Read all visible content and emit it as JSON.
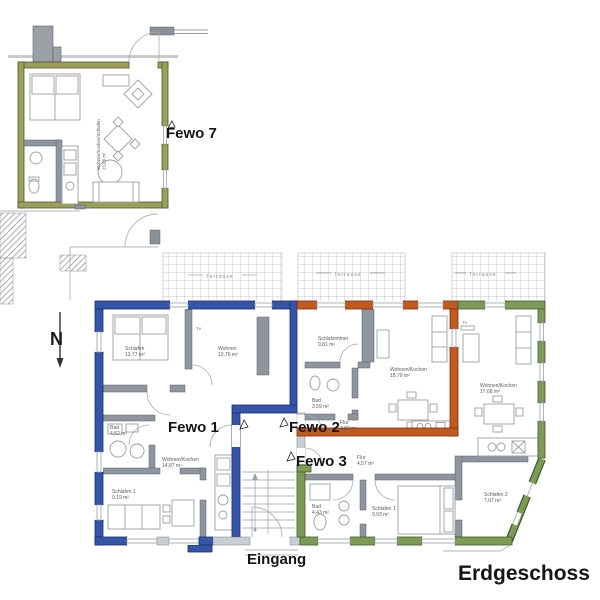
{
  "labels": {
    "fewo7": "Fewo 7",
    "fewo1": "Fewo 1",
    "fewo2": "Fewo 2",
    "fewo3": "Fewo 3",
    "eingang": "Eingang",
    "erdgeschoss": "Erdgeschoss",
    "north": "N",
    "tv": "TV"
  },
  "terraces": {
    "t1": "Terrasse",
    "t2": "Terrasse",
    "t3": "Terrasse"
  },
  "rooms": {
    "fewo7_main": {
      "name": "Wohnen/Kochen/Schlafen",
      "area": "23,08 m²"
    },
    "f1_schlafen": {
      "name": "Schlafen",
      "area": "13,77 m²"
    },
    "f1_wohnen": {
      "name": "Wohnen",
      "area": "13,76 m²"
    },
    "f1_bad": {
      "name": "Bad",
      "area": "4,52 m²"
    },
    "f1_wohnen_kochen": {
      "name": "Wohnen/Kochen",
      "area": "14,87 m²"
    },
    "f1_schlafen1": {
      "name": "Schlafen 1",
      "area": "9,19 m²"
    },
    "f2_schlafzimmer": {
      "name": "Schlafzimmer",
      "area": "9,81 m²"
    },
    "f2_bad": {
      "name": "Bad",
      "area": "3,59 m²"
    },
    "f2_flur": {
      "name": "Flur",
      "area": "3,83 m²"
    },
    "f2_wohnen_kochen": {
      "name": "Wohnen/Kochen",
      "area": "18,79 m²"
    },
    "f3_wohnen_kochen": {
      "name": "Wohnen/Kochen",
      "area": "17,68 m²"
    },
    "f3_flur": {
      "name": "Flur",
      "area": "4,57 m²"
    },
    "f3_bad": {
      "name": "Bad",
      "area": "4,43 m²"
    },
    "f3_schlafen1": {
      "name": "Schlafen 1",
      "area": "9,93 m²"
    },
    "f3_schlafen2": {
      "name": "Schlafen 2",
      "area": "7,07 m²"
    }
  },
  "colors": {
    "fewo1_outline": "#3555a8",
    "fewo2_outline": "#c05a1e",
    "fewo3_outline": "#7d9b57",
    "fewo7_outline": "#9aa05a",
    "interior_wall": "#8e959e"
  }
}
